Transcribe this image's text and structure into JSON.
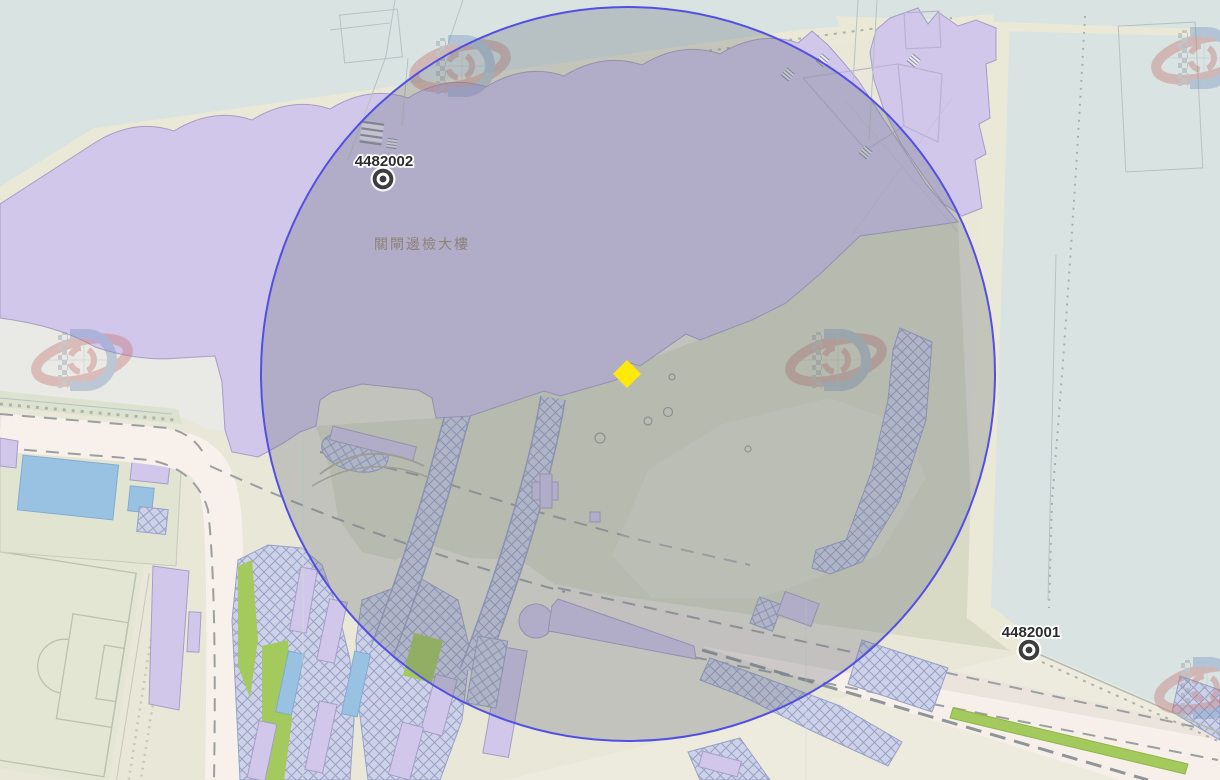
{
  "map": {
    "survey_markers": [
      {
        "label": "4482002"
      },
      {
        "label": "4482001"
      }
    ],
    "building_label": "關閘邊檢大樓",
    "selected_point_symbol": "yellow-diamond",
    "watermark_icon": "dscc-logo"
  },
  "colors": {
    "land": "#e8e7d8",
    "water": "#d8e3e2",
    "shore": "#eae8d6",
    "mid-land": "#d8dac6",
    "pale-land": "#ecebdd",
    "plaza": "#e9e9e5",
    "field": "#e3e6d3",
    "field-line": "#bcc1b2",
    "purple": "#d0c7ea",
    "purple-outline": "#a79ec6",
    "pink-road": "#f8f0ea",
    "pink-wedge": "#f7f0ea",
    "road-band": "#eae4dd",
    "green": "#a4c95c",
    "green-band": "#dce2cf",
    "pool": "#99c2e2",
    "hatch-bg": "#cdd2e8",
    "hatch-line": "#99a1c6",
    "dash": "#9aa0a0",
    "thin-line": "#b7c3c2",
    "overlay": "rgba(107,112,124,0.30)",
    "circle-stroke": "#544fe4",
    "diamond": "#ffe90a",
    "marker": "#3d3d3d",
    "label": "#2d2d2d",
    "cjk": "#8c8277",
    "wm-red": "#c4716e",
    "wm-blue": "#7492be"
  }
}
